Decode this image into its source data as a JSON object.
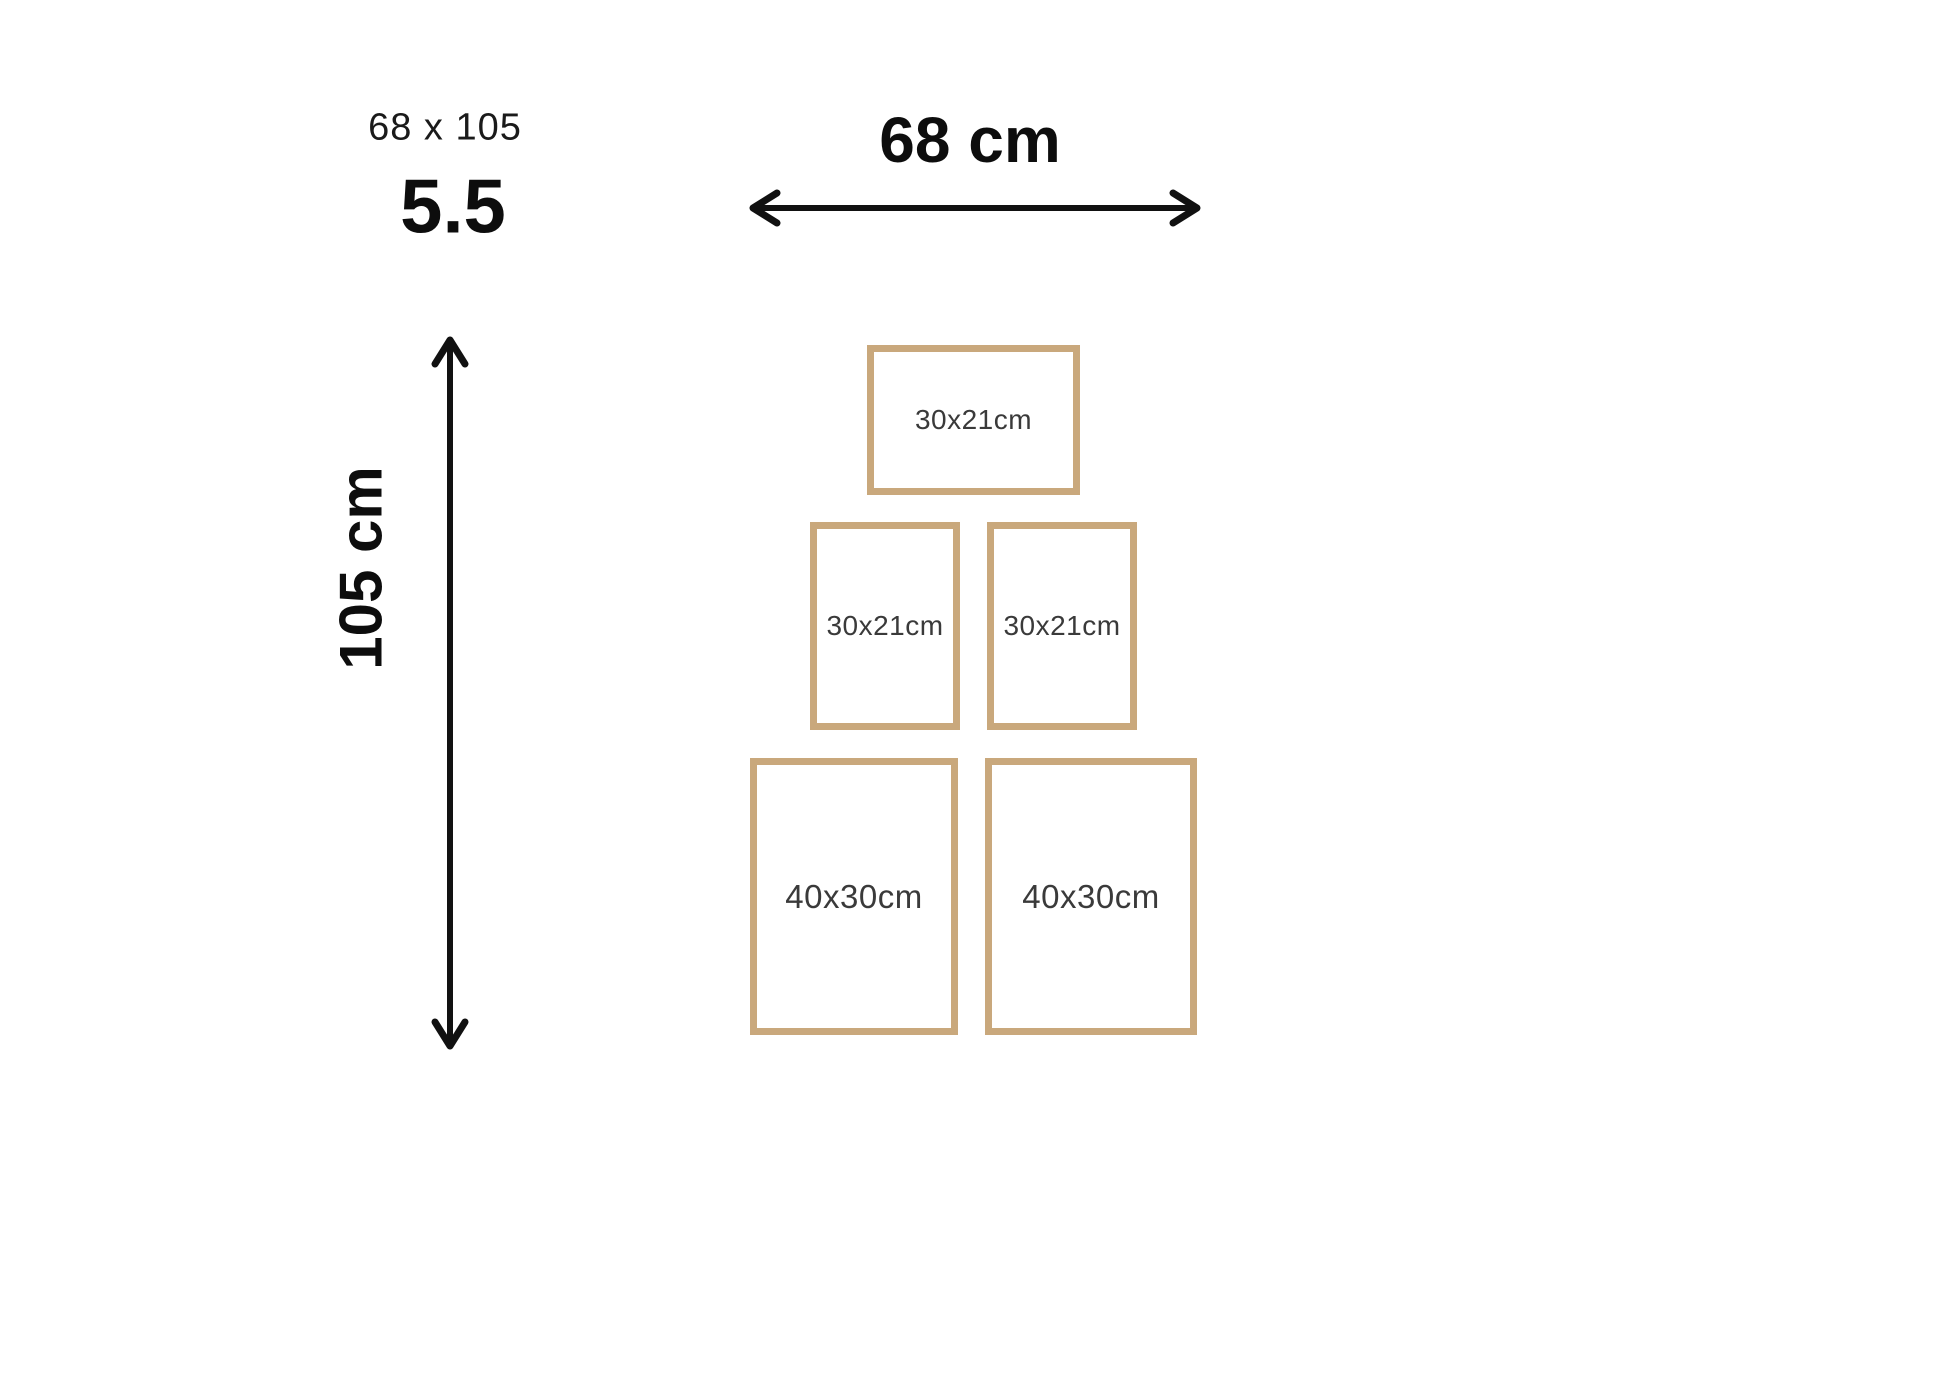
{
  "header": {
    "size_text": "68 x 105",
    "series_text": "5.5"
  },
  "width_dimension": {
    "label": "68 cm"
  },
  "height_dimension": {
    "label": "105 cm"
  },
  "frames": [
    {
      "position": "top-center",
      "label": "30x21cm",
      "size": "small",
      "orientation": "landscape"
    },
    {
      "position": "middle-left",
      "label": "30x21cm",
      "size": "small",
      "orientation": "portrait"
    },
    {
      "position": "middle-right",
      "label": "30x21cm",
      "size": "small",
      "orientation": "portrait"
    },
    {
      "position": "bottom-left",
      "label": "40x30cm",
      "size": "large",
      "orientation": "portrait"
    },
    {
      "position": "bottom-right",
      "label": "40x30cm",
      "size": "large",
      "orientation": "portrait"
    }
  ],
  "colors": {
    "background": "#ffffff",
    "frame_border": "#c9a87c",
    "ink": "#111111",
    "frame_label": "#3a3a3a"
  }
}
